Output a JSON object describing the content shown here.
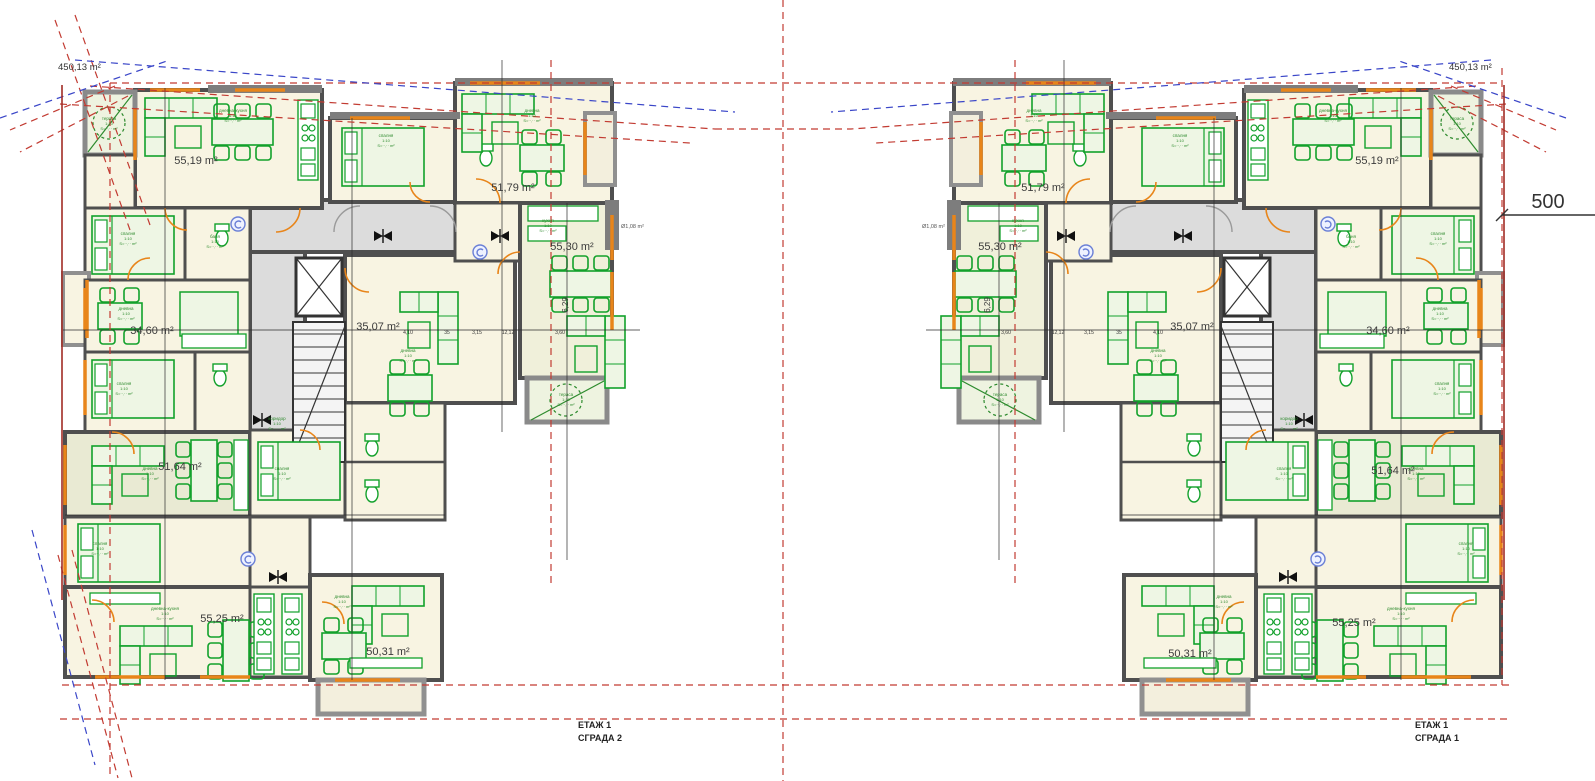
{
  "sheet": {
    "site_area_left": "450,13 m²",
    "site_area_right": "450,13 m²",
    "dim_500": "500",
    "small_area_left": "Ø1,08 m²",
    "small_area_right": "Ø1,08 m²",
    "title_left_line1": "ЕТАЖ 1",
    "title_left_line2": "СГРАДА 2",
    "title_right_line1": "ЕТАЖ 1",
    "title_right_line2": "СГРАДА 1"
  },
  "colors": {
    "room_cream": "#f8f4e2",
    "room_olive": "#e9ead3",
    "corridor_gray": "#dcdcdc",
    "wall_gray": "#4f4f4f",
    "furniture_green": "#12a12b",
    "door_orange": "#e8851a",
    "boundary_red": "#c23b32",
    "boundary_blue": "#3a46c8"
  },
  "apartment_labels": {
    "left": [
      {
        "t": "55,19 m²",
        "x": 196,
        "y": 164
      },
      {
        "t": "51,79 m²",
        "x": 513,
        "y": 191
      },
      {
        "t": "55,30 m²",
        "x": 572,
        "y": 250
      },
      {
        "t": "34,60 m²",
        "x": 152,
        "y": 334
      },
      {
        "t": "35,07 m²",
        "x": 378,
        "y": 330
      },
      {
        "t": "51,64 m²",
        "x": 180,
        "y": 470
      },
      {
        "t": "55,25 m²",
        "x": 222,
        "y": 622
      },
      {
        "t": "50,31 m²",
        "x": 388,
        "y": 655
      },
      {
        "t": "6,29",
        "x": 568,
        "y": 305,
        "r": -90,
        "size": 8
      }
    ],
    "right": [
      {
        "t": "51,79 m²",
        "x": 1043,
        "y": 191
      },
      {
        "t": "55,19 m²",
        "x": 1377,
        "y": 164
      },
      {
        "t": "55,30 m²",
        "x": 1000,
        "y": 250
      },
      {
        "t": "35,07 m²",
        "x": 1192,
        "y": 330
      },
      {
        "t": "34,60 m²",
        "x": 1388,
        "y": 334
      },
      {
        "t": "51,64 m²",
        "x": 1393,
        "y": 474
      },
      {
        "t": "50,31 m²",
        "x": 1190,
        "y": 657
      },
      {
        "t": "55,25 m²",
        "x": 1354,
        "y": 626
      },
      {
        "t": "6,29",
        "x": 990,
        "y": 305,
        "r": -90,
        "size": 8
      }
    ]
  },
  "micro": {
    "room_tags": [
      {
        "t": "дневна-кухня",
        "x": 233,
        "y": 112
      },
      {
        "t": "спалня",
        "x": 128,
        "y": 235
      },
      {
        "t": "баня",
        "x": 215,
        "y": 238
      },
      {
        "t": "дневна",
        "x": 126,
        "y": 310
      },
      {
        "t": "спалня",
        "x": 124,
        "y": 385
      },
      {
        "t": "дневна",
        "x": 408,
        "y": 352
      },
      {
        "t": "спалня",
        "x": 386,
        "y": 137
      },
      {
        "t": "дневна",
        "x": 532,
        "y": 112
      },
      {
        "t": "кухня",
        "x": 548,
        "y": 222
      },
      {
        "t": "дневна",
        "x": 150,
        "y": 470
      },
      {
        "t": "дневна-кухня",
        "x": 165,
        "y": 610
      },
      {
        "t": "дневна",
        "x": 342,
        "y": 598
      },
      {
        "t": "тераса",
        "x": 109,
        "y": 120
      },
      {
        "t": "тераса",
        "x": 566,
        "y": 396
      },
      {
        "t": "коридор",
        "x": 277,
        "y": 420
      },
      {
        "t": "спалня",
        "x": 100,
        "y": 545
      },
      {
        "t": "спалня",
        "x": 282,
        "y": 470
      }
    ],
    "tag_sub1": "1:10",
    "tag_sub2": "S=··,·· m²",
    "dims": [
      {
        "t": "4,10",
        "x": 408,
        "y": 334
      },
      {
        "t": "35",
        "x": 447,
        "y": 334
      },
      {
        "t": "3,15",
        "x": 477,
        "y": 334
      },
      {
        "t": "12,12",
        "x": 508,
        "y": 334
      },
      {
        "t": "3,60",
        "x": 560,
        "y": 334
      }
    ]
  }
}
